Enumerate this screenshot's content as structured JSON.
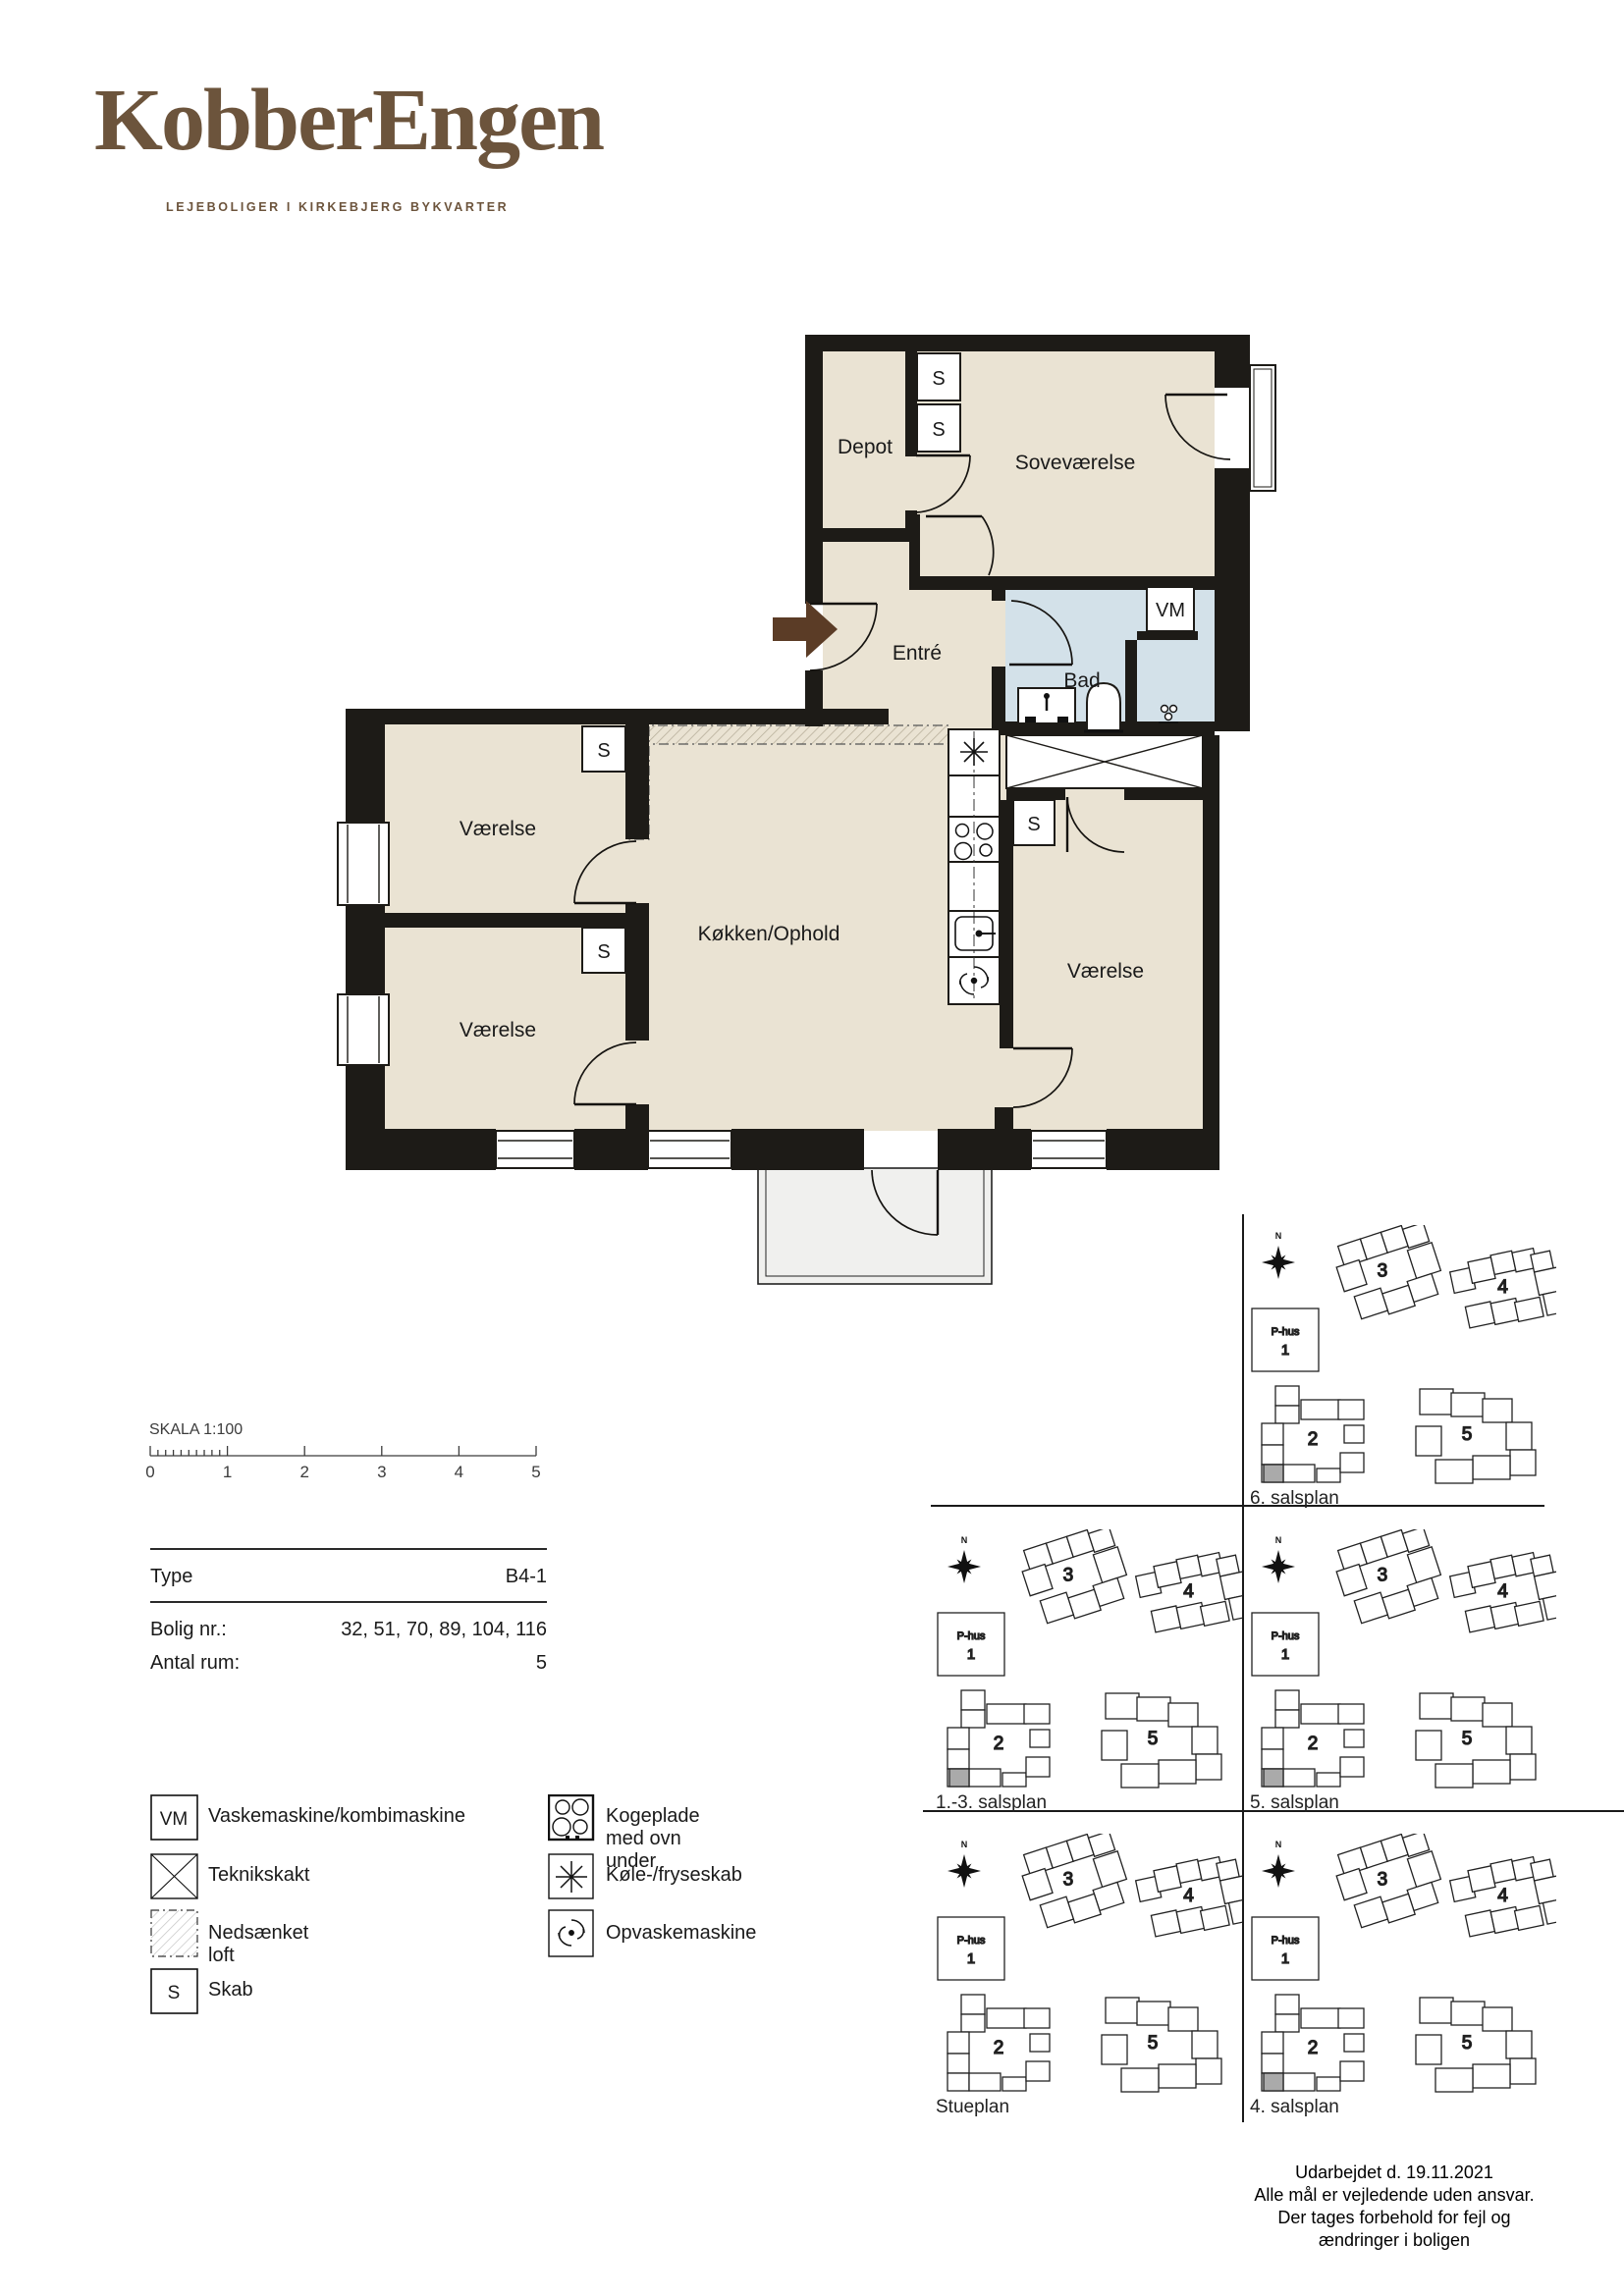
{
  "brand": {
    "name": "KobberEngen",
    "tagline": "LEJEBOLIGER I KIRKEBJERG BYKVARTER",
    "color": "#6c543c"
  },
  "floorplan": {
    "rooms": {
      "depot": "Depot",
      "sovevaerelse": "Soveværelse",
      "entre": "Entré",
      "bad": "Bad",
      "vaerelse_upper": "Værelse",
      "vaerelse_lower": "Værelse",
      "vaerelse_right": "Værelse",
      "kokken": "Køkken/Ophold"
    },
    "symbols": {
      "skab": "S",
      "vaskemaskine": "VM"
    },
    "colors": {
      "room": "#eae3d3",
      "bath": "#d3e1e9",
      "balcony": "#f0f0ee",
      "wall": "#1d1b17",
      "arrow": "#5b3c26",
      "highlight": "#aaaaaa"
    }
  },
  "scalebar": {
    "title": "SKALA 1:100",
    "ticks": [
      "0",
      "1",
      "2",
      "3",
      "4",
      "5"
    ]
  },
  "infotable": {
    "rows": [
      {
        "label": "Type",
        "value": "B4-1"
      },
      {
        "label": "Bolig nr.:",
        "value": "32, 51, 70, 89, 104, 116"
      },
      {
        "label": "Antal rum:",
        "value": "5"
      }
    ]
  },
  "legend": {
    "left": [
      {
        "icon": "vm-box-icon",
        "label": "Vaskemaskine/kombimaskine"
      },
      {
        "icon": "teknikskakt-icon",
        "label": "Teknikskakt"
      },
      {
        "icon": "nedsaenket-loft-icon",
        "label": "Nedsænket loft"
      },
      {
        "icon": "skab-icon",
        "label": "Skab"
      }
    ],
    "right": [
      {
        "icon": "kogeplade-icon",
        "label": "Kogeplade med ovn under"
      },
      {
        "icon": "koleskab-icon",
        "label": "Køle-/fryseskab"
      },
      {
        "icon": "opvaskemaskine-icon",
        "label": "Opvaskemaskine"
      }
    ]
  },
  "siteplans": {
    "compass": "N",
    "phus_line1": "P-hus",
    "phus_line2": "1",
    "building_numbers": {
      "b2": "2",
      "b3": "3",
      "b4": "4",
      "b5": "5"
    },
    "cells": [
      {
        "label": "6. salsplan",
        "highlight": true
      },
      {
        "label": "1.-3. salsplan",
        "highlight": true
      },
      {
        "label": "5. salsplan",
        "highlight": true
      },
      {
        "label": "Stueplan",
        "highlight": false
      },
      {
        "label": "4. salsplan",
        "highlight": true
      }
    ]
  },
  "footer": {
    "lines": [
      "Udarbejdet d. 19.11.2021",
      "Alle mål er vejledende uden ansvar.",
      "Der tages forbehold for fejl og",
      "ændringer i boligen"
    ]
  }
}
